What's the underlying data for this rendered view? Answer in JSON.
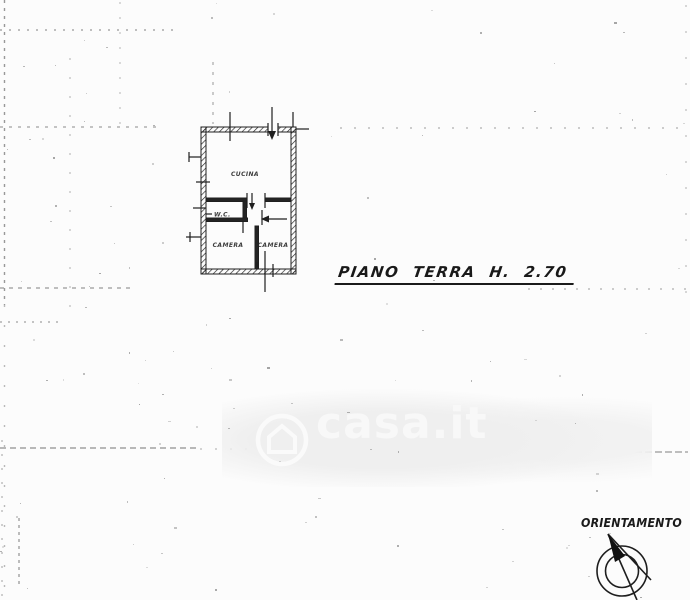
{
  "page": {
    "colors": {
      "paper": "#fcfcfc",
      "ink": "#1f1f1f",
      "watermark_gray": "#efefef",
      "watermark_text": "#f8f8f8"
    }
  },
  "floor_plan": {
    "rooms": [
      {
        "label": "CUCINA"
      },
      {
        "label": "W.C."
      },
      {
        "label": "CAMERA"
      },
      {
        "label": "CAMERA"
      }
    ],
    "caption": "PIANO TERRA H. 2.70"
  },
  "compass": {
    "label": "ORIENTAMENTO"
  },
  "watermark": {
    "text": "casa.it",
    "logo": "casa-house-logo"
  }
}
